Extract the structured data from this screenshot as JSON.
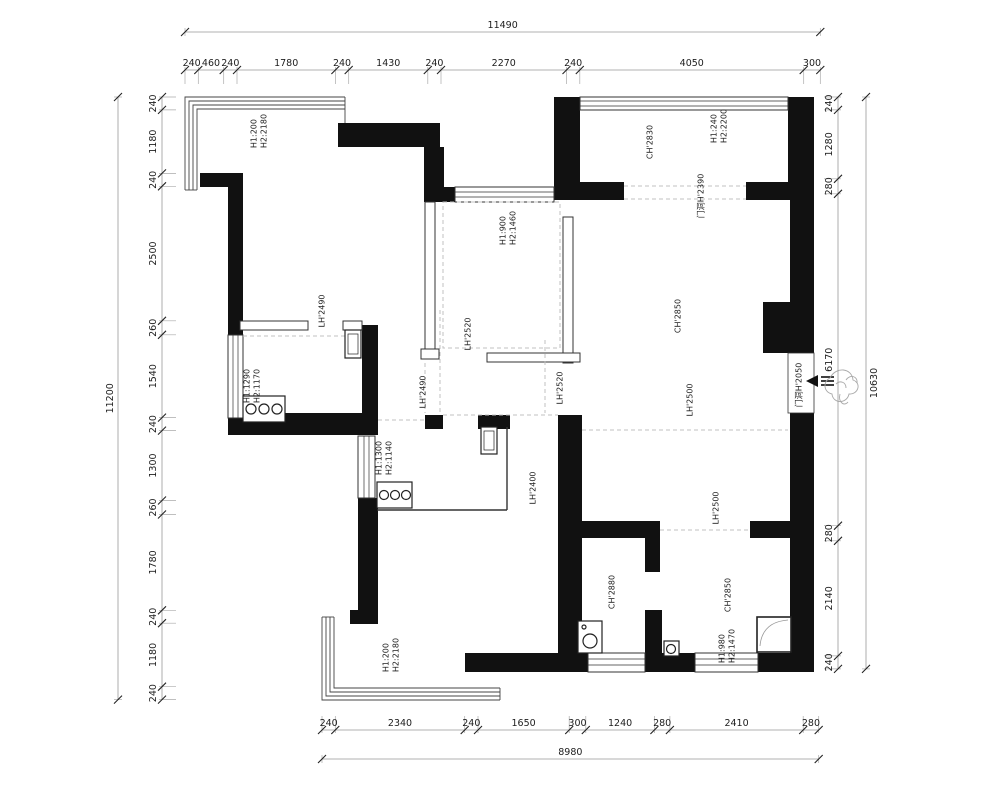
{
  "drawing": {
    "type": "architectural-floor-plan",
    "dims": {
      "top": {
        "total": "11490",
        "segments": [
          "240",
          "460",
          "240",
          "1780",
          "240",
          "1430",
          "240",
          "2270",
          "240",
          "4050",
          "300"
        ]
      },
      "left": {
        "total": "11200",
        "segments": [
          "240",
          "1180",
          "240",
          "2500",
          "260",
          "1540",
          "240",
          "1300",
          "260",
          "1780",
          "240",
          "1180",
          "240"
        ]
      },
      "right": {
        "total": "10630",
        "segments": [
          "240",
          "1280",
          "280",
          "6170",
          "280",
          "2140",
          "240"
        ]
      },
      "bottom": {
        "total": "8980",
        "segments": [
          "240",
          "2340",
          "240",
          "1650",
          "300",
          "1240",
          "280",
          "2410",
          "280"
        ]
      }
    },
    "plan_labels": {
      "bay_tl": {
        "l1": "H1:200",
        "l2": "H2:2180"
      },
      "win_mid_top": {
        "l1": "H1:900",
        "l2": "H2:1460"
      },
      "ch_top_right": {
        "l1": "CH'2830"
      },
      "win_top_right": {
        "l1": "H1:240",
        "l2": "H2:2200"
      },
      "door_top_right": {
        "l1": "门洞H'2390"
      },
      "lh_bedroom1": {
        "l1": "LH'2490"
      },
      "lh_mid_room": {
        "l1": "LH'2520"
      },
      "lh_dining_left": {
        "l1": "LH'2490"
      },
      "lh_dining_right": {
        "l1": "LH'2520"
      },
      "ch_living": {
        "l1": "CH'2850"
      },
      "lh_living": {
        "l1": "LH'2500"
      },
      "door_entry": {
        "l1": "门洞H'2050"
      },
      "win_kitchen": {
        "l1": "H1:1290",
        "l2": "H2:1170"
      },
      "win_left_mid": {
        "l1": "H1:1300",
        "l2": "H2:1140"
      },
      "lh_kitchen": {
        "l1": "LH'2400"
      },
      "lh_hallway": {
        "l1": "LH'2500"
      },
      "ch_bathroom": {
        "l1": "CH'2880"
      },
      "ch_bedroom2": {
        "l1": "CH'2850"
      },
      "win_bedroom2": {
        "l1": "H1:980",
        "l2": "H2:1470"
      },
      "bay_bl": {
        "l1": "H1:200",
        "l2": "H2:2180"
      }
    },
    "colors": {
      "wall": "#111111",
      "line": "#555555",
      "dim": "#1d1d1d",
      "dashed": "#c0c0c0",
      "bg": "#ffffff"
    }
  }
}
